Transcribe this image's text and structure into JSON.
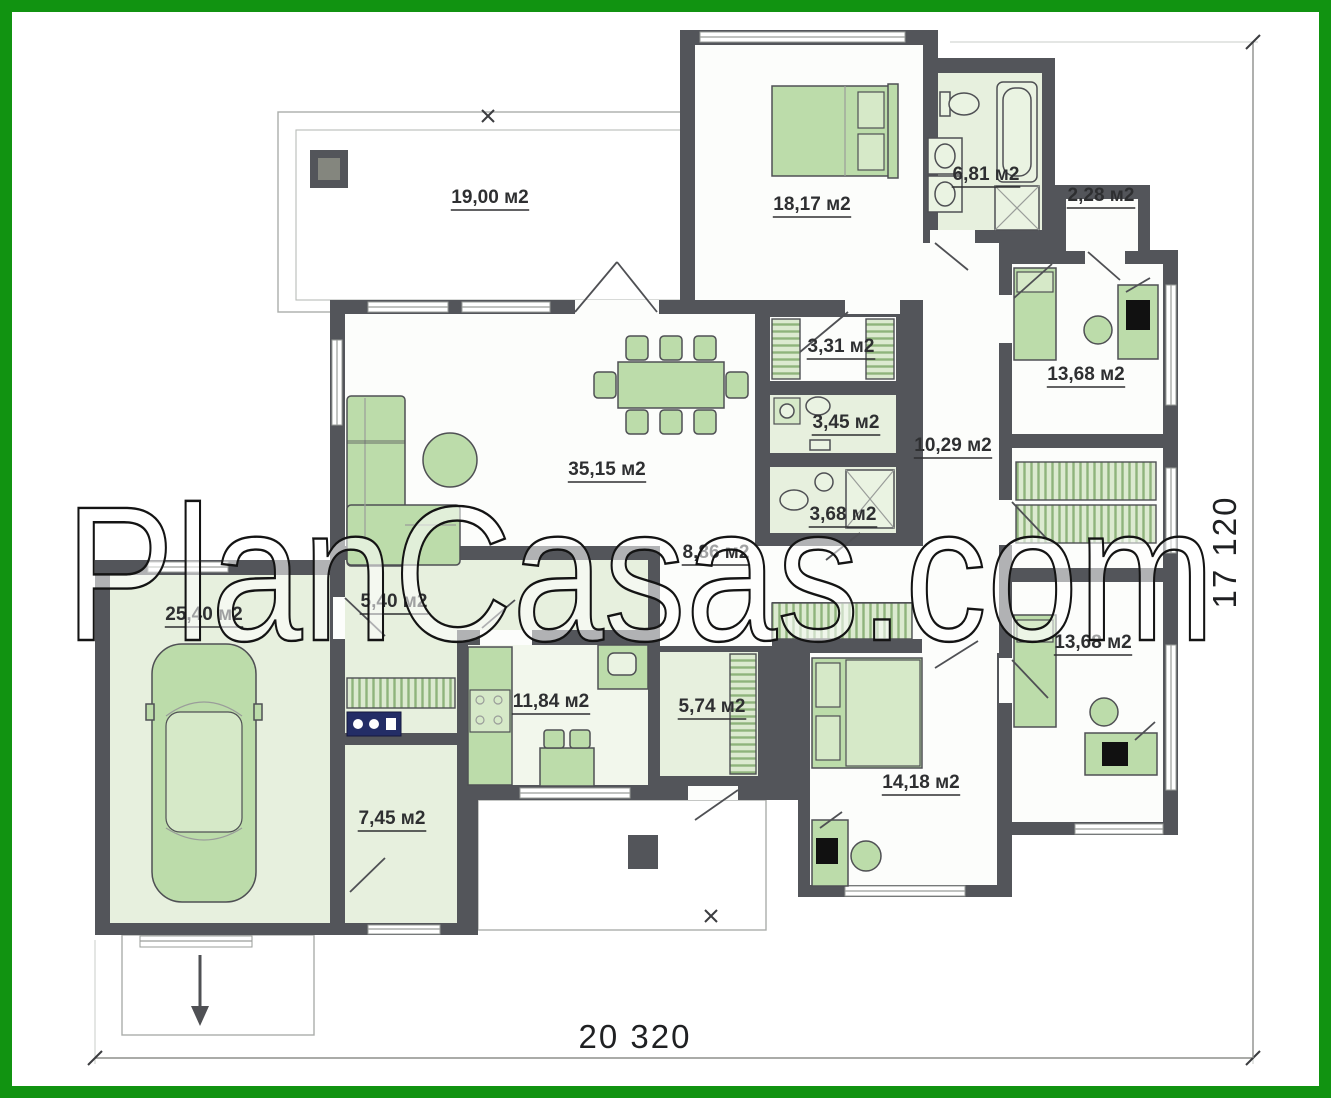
{
  "watermark": "PlanCasas.com",
  "dimensions": {
    "width_label": "20 320",
    "height_label": "17 120"
  },
  "unit_suffix": "м2",
  "rooms": [
    {
      "id": "terrace",
      "label": "19,00 м2",
      "x": 490,
      "y": 203
    },
    {
      "id": "bedroom-top",
      "label": "18,17 м2",
      "x": 812,
      "y": 210
    },
    {
      "id": "bathroom-main",
      "label": "6,81 м2",
      "x": 986,
      "y": 180
    },
    {
      "id": "storage",
      "label": "2,28 м2",
      "x": 1101,
      "y": 201
    },
    {
      "id": "bedroom-right-top",
      "label": "13,68 м2",
      "x": 1086,
      "y": 380
    },
    {
      "id": "closet",
      "label": "3,31 м2",
      "x": 841,
      "y": 352
    },
    {
      "id": "wc",
      "label": "3,45 м2",
      "x": 846,
      "y": 428
    },
    {
      "id": "hallway",
      "label": "10,29 м2",
      "x": 953,
      "y": 451
    },
    {
      "id": "living-room",
      "label": "35,15 м2",
      "x": 607,
      "y": 475
    },
    {
      "id": "shower-room",
      "label": "3,68 м2",
      "x": 843,
      "y": 520
    },
    {
      "id": "hall",
      "label": "8,86 м2",
      "x": 716,
      "y": 558
    },
    {
      "id": "mudroom",
      "label": "5,40 м2",
      "x": 394,
      "y": 607
    },
    {
      "id": "garage",
      "label": "25,40 м2",
      "x": 204,
      "y": 620
    },
    {
      "id": "kitchen",
      "label": "11,84 м2",
      "x": 551,
      "y": 707
    },
    {
      "id": "wardrobe",
      "label": "5,74 м2",
      "x": 712,
      "y": 712
    },
    {
      "id": "bedroom-right-bottom",
      "label": "13,68 м2",
      "x": 1093,
      "y": 648
    },
    {
      "id": "boiler-room",
      "label": "7,45 м2",
      "x": 392,
      "y": 824
    },
    {
      "id": "bedroom-bottom",
      "label": "14,18 м2",
      "x": 921,
      "y": 788
    }
  ],
  "colors": {
    "frame_green": "#119311",
    "walls": "#53555a",
    "room_tint": "#e7f0de",
    "furniture_green": "#bcdcaa"
  }
}
